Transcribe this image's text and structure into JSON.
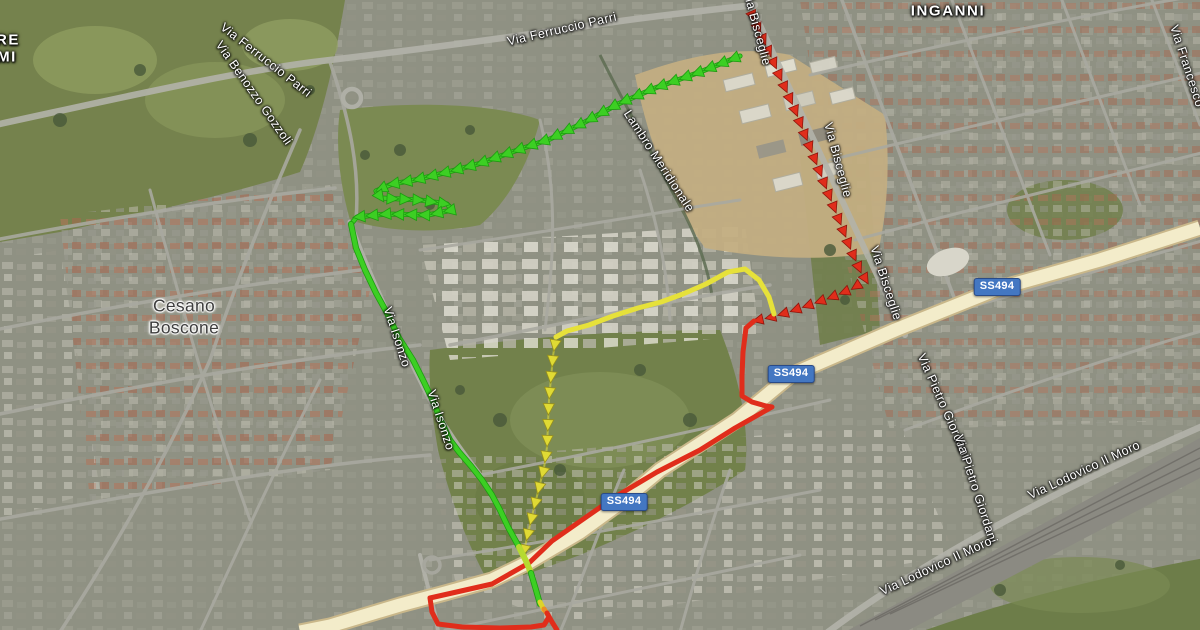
{
  "map": {
    "view_type": "satellite",
    "colors": {
      "route_green": "#3ccf23",
      "route_green_outline": "#1d9b10",
      "route_crossing_lightgreen": "#b6da30",
      "route_yellow": "#e6e13a",
      "route_yellow_marker": "#e0da34",
      "route_red": "#e02d1b",
      "transition_yellow": "#ddd32b",
      "transition_orange": "#ec8c26",
      "badge_blue": "#4377c2",
      "highway_fill": "#f3ecca"
    },
    "route_badges": [
      {
        "text": "SS494",
        "x": 997,
        "y": 287
      },
      {
        "text": "SS494",
        "x": 791,
        "y": 374
      },
      {
        "text": "SS494",
        "x": 624,
        "y": 502
      }
    ],
    "place_labels": [
      {
        "text": "Via Ferruccio Parri",
        "x": 266,
        "y": 60,
        "rotate": 38,
        "style": "road"
      },
      {
        "text": "Via Ferruccio Parri",
        "x": 562,
        "y": 29,
        "rotate": -13,
        "style": "road"
      },
      {
        "text": "Via Benozzo Gozzoli",
        "x": 254,
        "y": 93,
        "rotate": 55,
        "style": "road"
      },
      {
        "text": "INGANNI",
        "x": 948,
        "y": 11,
        "rotate": 0,
        "style": "district"
      },
      {
        "text": "RE",
        "x": 8,
        "y": 40,
        "rotate": 0,
        "style": "district"
      },
      {
        "text": "MI",
        "x": 7,
        "y": 57,
        "rotate": 0,
        "style": "district"
      },
      {
        "text": "Lambro Meridionale",
        "x": 659,
        "y": 161,
        "rotate": 57,
        "style": "road"
      },
      {
        "text": "Via Bisceglie",
        "x": 757,
        "y": 28,
        "rotate": 75,
        "style": "road"
      },
      {
        "text": "Via Bisceglie",
        "x": 838,
        "y": 160,
        "rotate": 75,
        "style": "road"
      },
      {
        "text": "Via Bisceglie",
        "x": 886,
        "y": 283,
        "rotate": 72,
        "style": "road"
      },
      {
        "text": "Via Francesco",
        "x": 1187,
        "y": 66,
        "rotate": 72,
        "style": "road"
      },
      {
        "text": "Cesano",
        "x": 184,
        "y": 306,
        "rotate": 0,
        "style": "city"
      },
      {
        "text": "Boscone",
        "x": 184,
        "y": 328,
        "rotate": 0,
        "style": "city"
      },
      {
        "text": "Via Isonzo",
        "x": 397,
        "y": 337,
        "rotate": 72,
        "style": "road"
      },
      {
        "text": "Via Isonzo",
        "x": 441,
        "y": 420,
        "rotate": 72,
        "style": "road"
      },
      {
        "text": "Via Pietro Giordani",
        "x": 944,
        "y": 406,
        "rotate": 66,
        "style": "road"
      },
      {
        "text": "Via Pietro Giordani",
        "x": 976,
        "y": 489,
        "rotate": 72,
        "style": "road"
      },
      {
        "text": "Via Lodovico Il Moro",
        "x": 1084,
        "y": 470,
        "rotate": -25,
        "style": "road"
      },
      {
        "text": "Via Lodovico Il Moro",
        "x": 936,
        "y": 566,
        "rotate": -25,
        "style": "road"
      }
    ],
    "routes": [
      {
        "name": "red-route-bisceglie-dashed",
        "color": "#e02d1b",
        "width": 0,
        "marker": "arrow",
        "marker_size": 5.2,
        "marker_interval": 13,
        "marker_outline": "#8e150c",
        "points": [
          [
            750,
            10
          ],
          [
            759,
            30
          ],
          [
            768,
            50
          ],
          [
            777,
            70
          ],
          [
            786,
            90
          ],
          [
            795,
            110
          ],
          [
            803,
            130
          ],
          [
            811,
            150
          ],
          [
            819,
            170
          ],
          [
            827,
            190
          ],
          [
            835,
            210
          ],
          [
            843,
            230
          ],
          [
            851,
            250
          ],
          [
            859,
            268
          ],
          [
            866,
            280
          ],
          [
            852,
            289
          ],
          [
            832,
            297
          ],
          [
            812,
            304
          ],
          [
            792,
            311
          ],
          [
            772,
            317
          ],
          [
            754,
            321
          ]
        ]
      },
      {
        "name": "red-route-solid",
        "color": "#e02d1b",
        "width": 5,
        "points": [
          [
            754,
            321
          ],
          [
            746,
            328
          ],
          [
            743,
            352
          ],
          [
            742,
            376
          ],
          [
            742,
            396
          ],
          [
            752,
            402
          ],
          [
            766,
            406
          ],
          [
            772,
            407
          ],
          [
            735,
            428
          ],
          [
            700,
            450
          ],
          [
            657,
            472
          ],
          [
            615,
            497
          ],
          [
            582,
            520
          ],
          [
            552,
            541
          ],
          [
            529,
            563
          ],
          [
            492,
            584
          ],
          [
            430,
            598
          ],
          [
            432,
            612
          ],
          [
            438,
            624
          ],
          [
            462,
            627
          ],
          [
            500,
            628
          ],
          [
            531,
            627
          ],
          [
            544,
            625
          ],
          [
            549,
            617
          ]
        ]
      },
      {
        "name": "yellow-route-smooth",
        "color": "#e6e13a",
        "width": 5,
        "points": [
          [
            774,
            314
          ],
          [
            769,
            297
          ],
          [
            759,
            280
          ],
          [
            745,
            269
          ],
          [
            728,
            272
          ],
          [
            706,
            284
          ],
          [
            683,
            294
          ],
          [
            661,
            302
          ],
          [
            638,
            308
          ],
          [
            613,
            316
          ],
          [
            589,
            325
          ],
          [
            567,
            331
          ],
          [
            556,
            337
          ]
        ]
      },
      {
        "name": "yellow-route-arrows",
        "color": "#e6e13a",
        "width": 2,
        "opacity": 0.55,
        "marker": "arrow",
        "marker_color": "#e0da34",
        "marker_size": 5.6,
        "marker_interval": 16,
        "marker_outline": "#97901c",
        "points": [
          [
            556,
            337
          ],
          [
            553,
            356
          ],
          [
            551,
            378
          ],
          [
            549,
            400
          ],
          [
            548,
            424
          ],
          [
            547,
            447
          ],
          [
            544,
            468
          ],
          [
            538,
            492
          ],
          [
            532,
            516
          ],
          [
            527,
            538
          ],
          [
            524,
            551
          ]
        ]
      },
      {
        "name": "green-route-chevrons",
        "color": "#3ccf23",
        "width": 3.5,
        "outline": "#1d9b10",
        "marker": "arrow",
        "marker_color": "#3ccf23",
        "marker_size": 5.8,
        "marker_interval": 13,
        "marker_outline": "#1d9b10",
        "points": [
          [
            740,
            56
          ],
          [
            700,
            72
          ],
          [
            655,
            88
          ],
          [
            618,
            104
          ],
          [
            585,
            122
          ],
          [
            550,
            139
          ],
          [
            512,
            152
          ],
          [
            478,
            164
          ],
          [
            448,
            172
          ],
          [
            415,
            180
          ],
          [
            392,
            184
          ],
          [
            376,
            191
          ],
          [
            381,
            198
          ],
          [
            420,
            200
          ],
          [
            447,
            204
          ],
          [
            452,
            210
          ],
          [
            428,
            215
          ],
          [
            386,
            214
          ],
          [
            357,
            217
          ],
          [
            351,
            224
          ]
        ]
      },
      {
        "name": "green-route-smooth",
        "color": "#3ccf23",
        "width": 4.5,
        "outline": "#1d9b10",
        "points": [
          [
            351,
            224
          ],
          [
            356,
            248
          ],
          [
            365,
            270
          ],
          [
            376,
            293
          ],
          [
            387,
            313
          ],
          [
            399,
            338
          ],
          [
            413,
            360
          ],
          [
            424,
            382
          ],
          [
            433,
            401
          ],
          [
            441,
            421
          ],
          [
            450,
            440
          ],
          [
            459,
            452
          ],
          [
            471,
            466
          ],
          [
            482,
            480
          ],
          [
            492,
            495
          ],
          [
            500,
            510
          ],
          [
            508,
            527
          ],
          [
            519,
            547
          ]
        ]
      },
      {
        "name": "green-route-highway-crossing",
        "color": "#b6da30",
        "width": 6,
        "points": [
          [
            519,
            547
          ],
          [
            526,
            561
          ],
          [
            531,
            573
          ]
        ]
      },
      {
        "name": "green-route-south",
        "color": "#3ccf23",
        "width": 4.5,
        "outline": "#1d9b10",
        "points": [
          [
            531,
            573
          ],
          [
            536,
            590
          ],
          [
            540,
            604
          ]
        ]
      },
      {
        "name": "transition-yellow-segment",
        "color": "#ddd32b",
        "width": 5,
        "points": [
          [
            540,
            602
          ],
          [
            544,
            610
          ]
        ]
      },
      {
        "name": "transition-orange-segment",
        "color": "#ec8c26",
        "width": 5,
        "points": [
          [
            544,
            609
          ],
          [
            548,
            615
          ]
        ]
      },
      {
        "name": "red-route-tail",
        "color": "#e02d1b",
        "width": 5,
        "points": [
          [
            547,
            613
          ],
          [
            552,
            622
          ],
          [
            557,
            630
          ]
        ]
      }
    ]
  }
}
